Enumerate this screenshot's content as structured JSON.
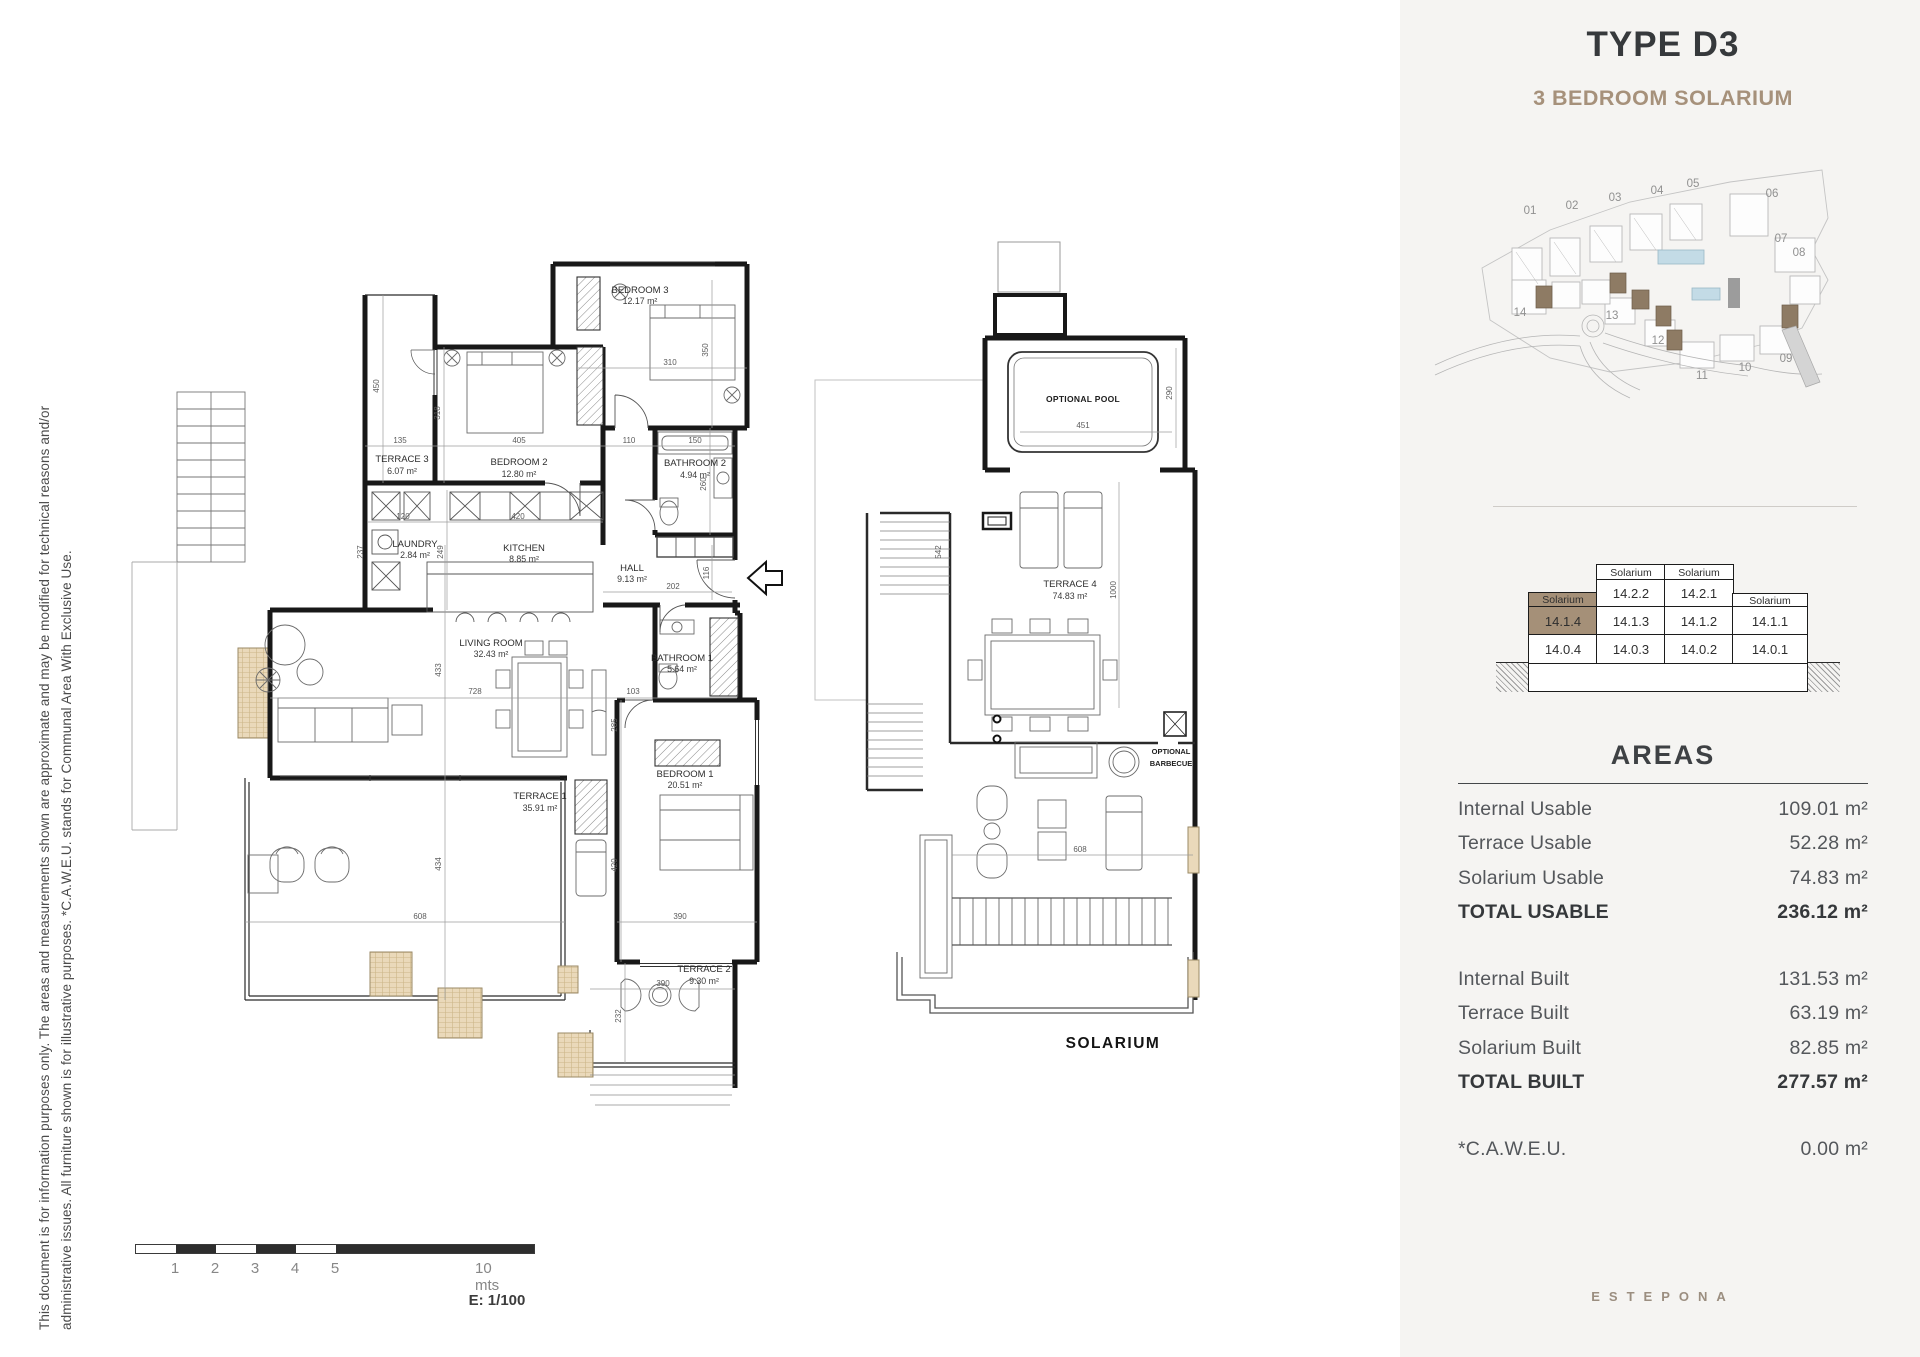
{
  "disclaimer": {
    "line1": "This document is for information purposes only. The areas and measurements shown are approximate and may be modified for technical reasons and/or",
    "line2": "administrative issues. All furniture shown is for illustrative purposes. *C.A.W.E.U. stands for Communal Area With Exclusive Use."
  },
  "header": {
    "title": "TYPE D3",
    "subtitle": "3 BEDROOM SOLARIUM"
  },
  "site_plan": {
    "building_numbers": [
      "01",
      "02",
      "03",
      "04",
      "05",
      "06",
      "07",
      "08",
      "09",
      "10",
      "11",
      "12",
      "13",
      "14"
    ]
  },
  "stack": {
    "col1": {
      "header": "Solarium",
      "r1": "14.1.4",
      "r2": "14.0.4"
    },
    "col2": {
      "header": "Solarium",
      "r0": "14.2.2",
      "r1": "14.1.3",
      "r2": "14.0.3"
    },
    "col3": {
      "header": "Solarium",
      "r0": "14.2.1",
      "r1": "14.1.2",
      "r2": "14.0.2"
    },
    "col4": {
      "header": "Solarium",
      "r1": "14.1.1",
      "r2": "14.0.1"
    }
  },
  "areas": {
    "title": "AREAS",
    "rows_usable": [
      {
        "label": "Internal Usable",
        "value": "109.01 m²"
      },
      {
        "label": "Terrace Usable",
        "value": "52.28 m²"
      },
      {
        "label": "Solarium Usable",
        "value": "74.83 m²"
      }
    ],
    "total_usable": {
      "label": "TOTAL USABLE",
      "value": "236.12 m²"
    },
    "rows_built": [
      {
        "label": "Internal Built",
        "value": "131.53 m²"
      },
      {
        "label": "Terrace Built",
        "value": "63.19 m²"
      },
      {
        "label": "Solarium Built",
        "value": "82.85 m²"
      }
    ],
    "total_built": {
      "label": "TOTAL BUILT",
      "value": "277.57 m²"
    },
    "caweu": {
      "label": "*C.A.W.E.U.",
      "value": "0.00 m²"
    }
  },
  "floorplan": {
    "rooms": {
      "bedroom3": {
        "name": "BEDROOM 3",
        "area": "12.17 m²"
      },
      "terrace3": {
        "name": "TERRACE 3",
        "area": "6.07 m²"
      },
      "bedroom2": {
        "name": "BEDROOM 2",
        "area": "12.80 m²"
      },
      "bathroom2": {
        "name": "BATHROOM 2",
        "area": "4.94 m²"
      },
      "laundry": {
        "name": "LAUNDRY",
        "area": "2.84 m²"
      },
      "kitchen": {
        "name": "KITCHEN",
        "area": "8.85 m²"
      },
      "hall": {
        "name": "HALL",
        "area": "9.13 m²"
      },
      "livingroom": {
        "name": "LIVING ROOM",
        "area": "32.43 m²"
      },
      "bathroom1": {
        "name": "BATHROOM 1",
        "area": "5.64 m²"
      },
      "bedroom1": {
        "name": "BEDROOM 1",
        "area": "20.51 m²"
      },
      "terrace1": {
        "name": "TERRACE 1",
        "area": "35.91 m²"
      },
      "terrace2": {
        "name": "TERRACE 2",
        "area": "9.30 m²"
      }
    },
    "dims": {
      "d450": "450",
      "d318": "318",
      "d135": "135",
      "d405": "405",
      "d110": "110",
      "d150": "150",
      "d310": "310",
      "d350": "350",
      "d120": "120",
      "d420a": "420",
      "d237": "237",
      "d249": "249",
      "d260": "260",
      "d202": "202",
      "d116": "116",
      "d728": "728",
      "d103": "103",
      "d433": "433",
      "d434": "434",
      "d285": "285",
      "d420b": "420",
      "d390a": "390",
      "d608": "608",
      "d390b": "390",
      "d232": "232"
    }
  },
  "solarium": {
    "pool_label": "OPTIONAL POOL",
    "terrace4": {
      "name": "TERRACE 4",
      "area": "74.83 m²"
    },
    "barbecue_line1": "OPTIONAL",
    "barbecue_line2": "BARBECUE",
    "plan_label": "SOLARIUM",
    "dims": {
      "s451": "451",
      "s290": "290",
      "s1000": "1000",
      "s608": "608",
      "s542": "542"
    }
  },
  "scalebar": {
    "ticks": [
      "1",
      "2",
      "3",
      "4",
      "5"
    ],
    "end_label": "10 mts",
    "scale_label": "E: 1/100"
  },
  "footer": {
    "brand": "ESTEPONA"
  },
  "colors": {
    "accent": "#a6917b",
    "panel": "#f5f4f2",
    "highlight": "#a59078",
    "pool": "#c3dbe6"
  }
}
